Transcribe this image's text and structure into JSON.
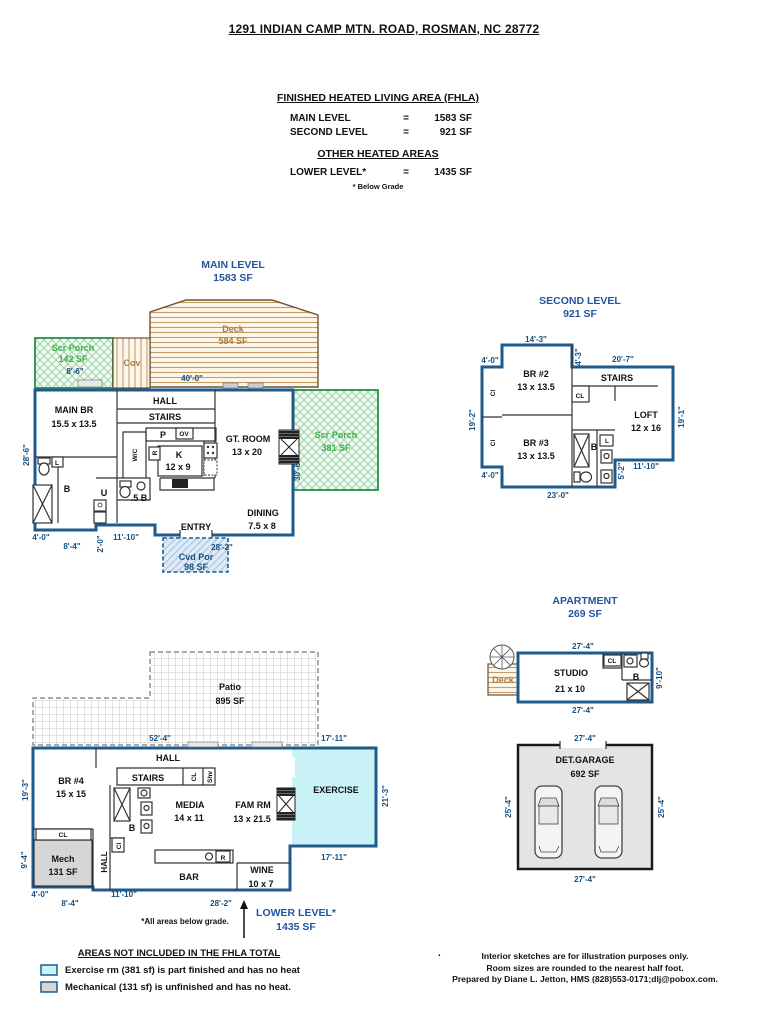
{
  "header": {
    "address": "1291 INDIAN CAMP MTN. ROAD, ROSMAN, NC 28772",
    "fhla_title": "FINISHED HEATED LIVING AREA (FHLA)",
    "rows": [
      {
        "label": "MAIN LEVEL",
        "eq": "=",
        "value": "1583 SF"
      },
      {
        "label": "SECOND LEVEL",
        "eq": "=",
        "value": "921 SF"
      }
    ],
    "other_title": "OTHER HEATED AREAS",
    "other_rows": [
      {
        "label": "LOWER LEVEL*",
        "eq": "=",
        "value": "1435 SF"
      }
    ],
    "note": "* Below Grade"
  },
  "main_level": {
    "title": "MAIN LEVEL",
    "area": "1583 SF",
    "deck": {
      "name": "Deck",
      "area": "584 SF"
    },
    "scr_porch_left": {
      "name": "Scr Porch",
      "area": "142 SF",
      "dim": "8'-6\""
    },
    "cov": "Cov",
    "dim_top": "40'-0\"",
    "hall": "HALL",
    "stairs": "STAIRS",
    "main_br": {
      "name": "MAIN BR",
      "size": "15.5 x 13.5"
    },
    "pantry": "P",
    "oven": "OV",
    "wic": "W/C",
    "fridge": "R",
    "kitchen": {
      "name": "K",
      "size": "12 x 9"
    },
    "gt_room": {
      "name": "GT. ROOM",
      "size": "13 x 20"
    },
    "scr_porch_right": {
      "name": "Scr Porch",
      "area": "381 SF"
    },
    "bath": "B",
    "linen": "L",
    "utility": "U",
    "half_bath": ".5 B",
    "dining": {
      "name": "DINING",
      "size": "7.5 x 8"
    },
    "entry": "ENTRY",
    "cvd_por": {
      "name": "Cvd Por",
      "area": "98 SF"
    },
    "dim_left": "28'-6\"",
    "dim_right": "30'-6\"",
    "dims_bottom": {
      "b1": "4'-0\"",
      "b2": "8'-4\"",
      "b3": "2'-0\"",
      "b4": "11'-10\"",
      "b5": "28'-2\""
    }
  },
  "second_level": {
    "title": "SECOND LEVEL",
    "area": "921 SF",
    "br2": {
      "name": "BR #2",
      "size": "13 x 13.5"
    },
    "br3": {
      "name": "BR #3",
      "size": "13 x 13.5"
    },
    "stairs": "STAIRS",
    "cl": "CL",
    "cl_left_top": "Cl",
    "cl_left_bottom": "Cl",
    "loft": {
      "name": "LOFT",
      "size": "12 x 16"
    },
    "bath": "B",
    "linen": "L",
    "dims": {
      "top": "14'-3\"",
      "top_left": "4'-0\"",
      "mid_v": "4'-3\"",
      "top_right": "20'-7\"",
      "left": "19'-2\"",
      "right": "19'-1\"",
      "step_v": "5'-2\"",
      "step_h": "11'-10\"",
      "bottom_left": "4'-0\"",
      "bottom": "23'-0\""
    }
  },
  "apartment": {
    "title": "APARTMENT",
    "area": "269 SF",
    "studio": {
      "name": "STUDIO",
      "size": "21 x 10"
    },
    "deck": "Deck",
    "cl": "CL",
    "bath": "B",
    "dims": {
      "top": "27'-4\"",
      "bottom": "27'-4\"",
      "right": "9'-10\""
    }
  },
  "garage": {
    "title": "DET.GARAGE",
    "area": "692 SF",
    "dims": {
      "top": "27'-4\"",
      "bottom": "27'-4\"",
      "left": "25'-4\"",
      "right": "25'-4\""
    }
  },
  "lower_level": {
    "title": "LOWER LEVEL*",
    "area": "1435 SF",
    "patio": {
      "name": "Patio",
      "area": "895 SF"
    },
    "hall": "HALL",
    "hall_v": "HALL",
    "br4": {
      "name": "BR #4",
      "size": "15 x 15"
    },
    "stairs": "STAIRS",
    "cl_stairs": "CL",
    "shv": "Shv",
    "media": {
      "name": "MEDIA",
      "size": "14 x 11"
    },
    "fam_rm": {
      "name": "FAM RM",
      "size": "13 x 21.5"
    },
    "exercise": "EXERCISE",
    "bath": "B",
    "cl_hall": "Cl",
    "mech": {
      "name": "Mech",
      "area": "131 SF"
    },
    "cl_mech": "CL",
    "bar": "BAR",
    "fridge": "R",
    "wine": {
      "name": "WINE",
      "size": "10 x 7"
    },
    "note": "*All areas below grade.",
    "dims": {
      "patio_w": "52'-4\"",
      "ex_top": "17'-11\"",
      "ex_bottom": "17'-11\"",
      "left": "19'-3\"",
      "right": "21'-3\"",
      "mech_left": "9'-4\"",
      "b1": "4'-0\"",
      "b2": "8'-4\"",
      "b3": "11'-10\"",
      "b4": "28'-2\""
    }
  },
  "footer": {
    "legend_title": "AREAS NOT INCLUDED IN THE FHLA TOTAL",
    "legend": [
      {
        "text": "Exercise rm (381 sf) is part finished and has no heat",
        "color": "#c9f2f7"
      },
      {
        "text": "Mechanical (131 sf) is unfinished and has no heat.",
        "color": "#d6d6d6"
      }
    ],
    "dot": ".",
    "disclaimer": {
      "line1": "Interior sketches are for illustration purposes only.",
      "line2": "Room sizes are rounded to the nearest half foot.",
      "line3": "Prepared by Diane L. Jetton, HMS (828)553-0171;dlj@pobox.com."
    }
  },
  "colors": {
    "wall_blue": "#1e5a8c",
    "title_blue": "#2355a0",
    "dim_blue": "#164f7e",
    "porch_green": "#3fae49",
    "deck_tan": "#a97c3f",
    "exercise_fill": "#c9f2f7",
    "mech_fill": "#d6d6d6",
    "garage_fill": "#e4e4e4"
  }
}
